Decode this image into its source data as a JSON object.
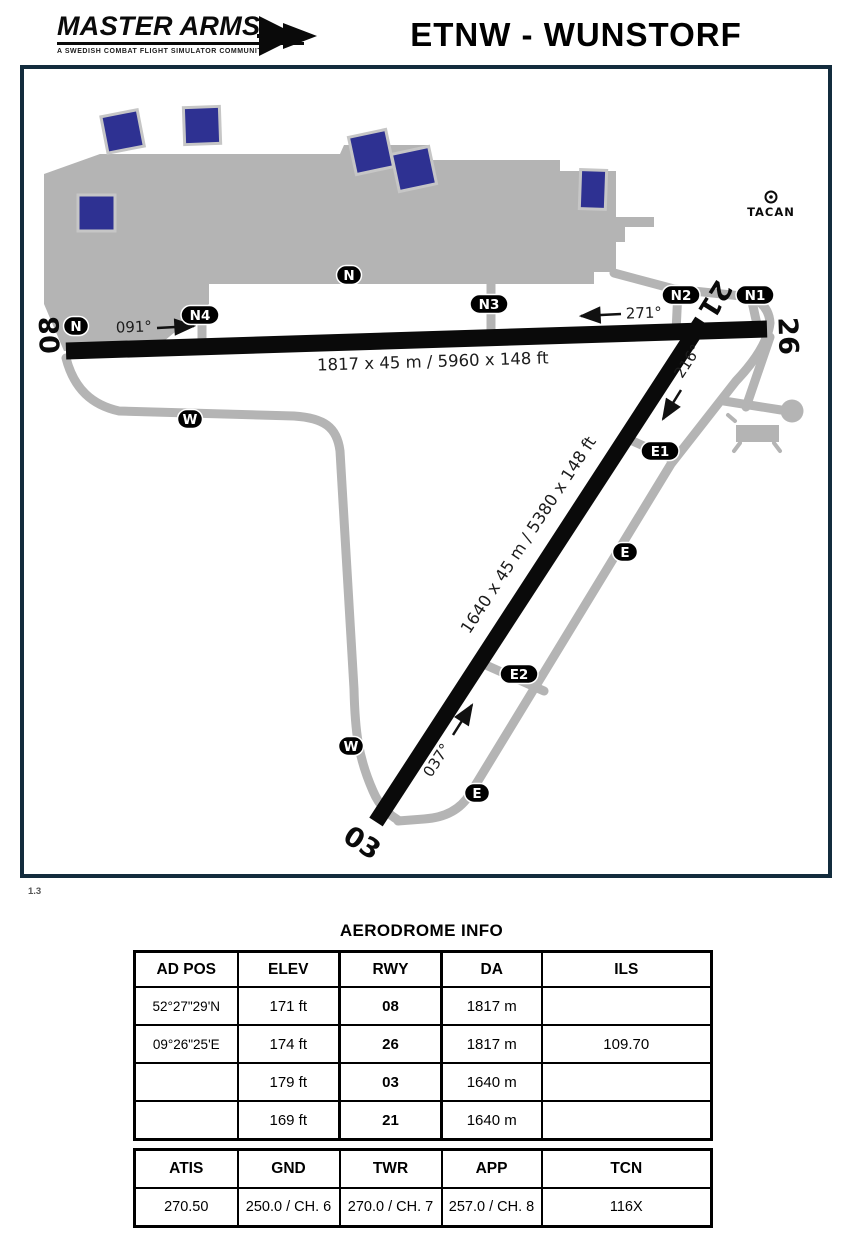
{
  "header": {
    "logo_title": "MASTER ARMS",
    "logo_tagline": "A SWEDISH COMBAT FLIGHT SIMULATOR COMMUNITY",
    "page_title": "ETNW - WUNSTORF"
  },
  "diagram": {
    "version": "1.3",
    "tacan_label": "TACAN",
    "runway_ends": [
      "08",
      "26",
      "21",
      "03"
    ],
    "runway_dims": {
      "main": "1817 x 45 m / 5960 x 148 ft",
      "cross": "1640 x 45 m / 5380 x 148 ft"
    },
    "headings": [
      "091°",
      "271°",
      "216°",
      "037°"
    ],
    "pills": [
      {
        "label": "N"
      },
      {
        "label": "N"
      },
      {
        "label": "N4"
      },
      {
        "label": "N3"
      },
      {
        "label": "N2"
      },
      {
        "label": "N1"
      },
      {
        "label": "E1"
      },
      {
        "label": "E"
      },
      {
        "label": "E2"
      },
      {
        "label": "E"
      },
      {
        "label": "W"
      },
      {
        "label": "W"
      }
    ]
  },
  "aerodrome_info": {
    "title": "AERODROME INFO",
    "headers": [
      "AD POS",
      "ELEV",
      "RWY",
      "DA",
      "ILS"
    ],
    "rows": [
      [
        "52°27\"29'N",
        "171 ft",
        "08",
        "1817 m",
        ""
      ],
      [
        "09°26\"25'E",
        "174 ft",
        "26",
        "1817 m",
        "109.70"
      ],
      [
        "",
        "179 ft",
        "03",
        "1640 m",
        ""
      ],
      [
        "",
        "169 ft",
        "21",
        "1640 m",
        ""
      ]
    ]
  },
  "frequencies": {
    "headers": [
      "ATIS",
      "GND",
      "TWR",
      "APP",
      "TCN"
    ],
    "row": [
      "270.50",
      "250.0 / CH. 6",
      "270.0 / CH. 7",
      "257.0 / CH. 8",
      "116X"
    ]
  },
  "colors": {
    "frame_navy": "#132c3d",
    "apron_gray": "#b4b4b4",
    "building_blue": "#2e3192",
    "runway_black": "#0a0a0a"
  }
}
